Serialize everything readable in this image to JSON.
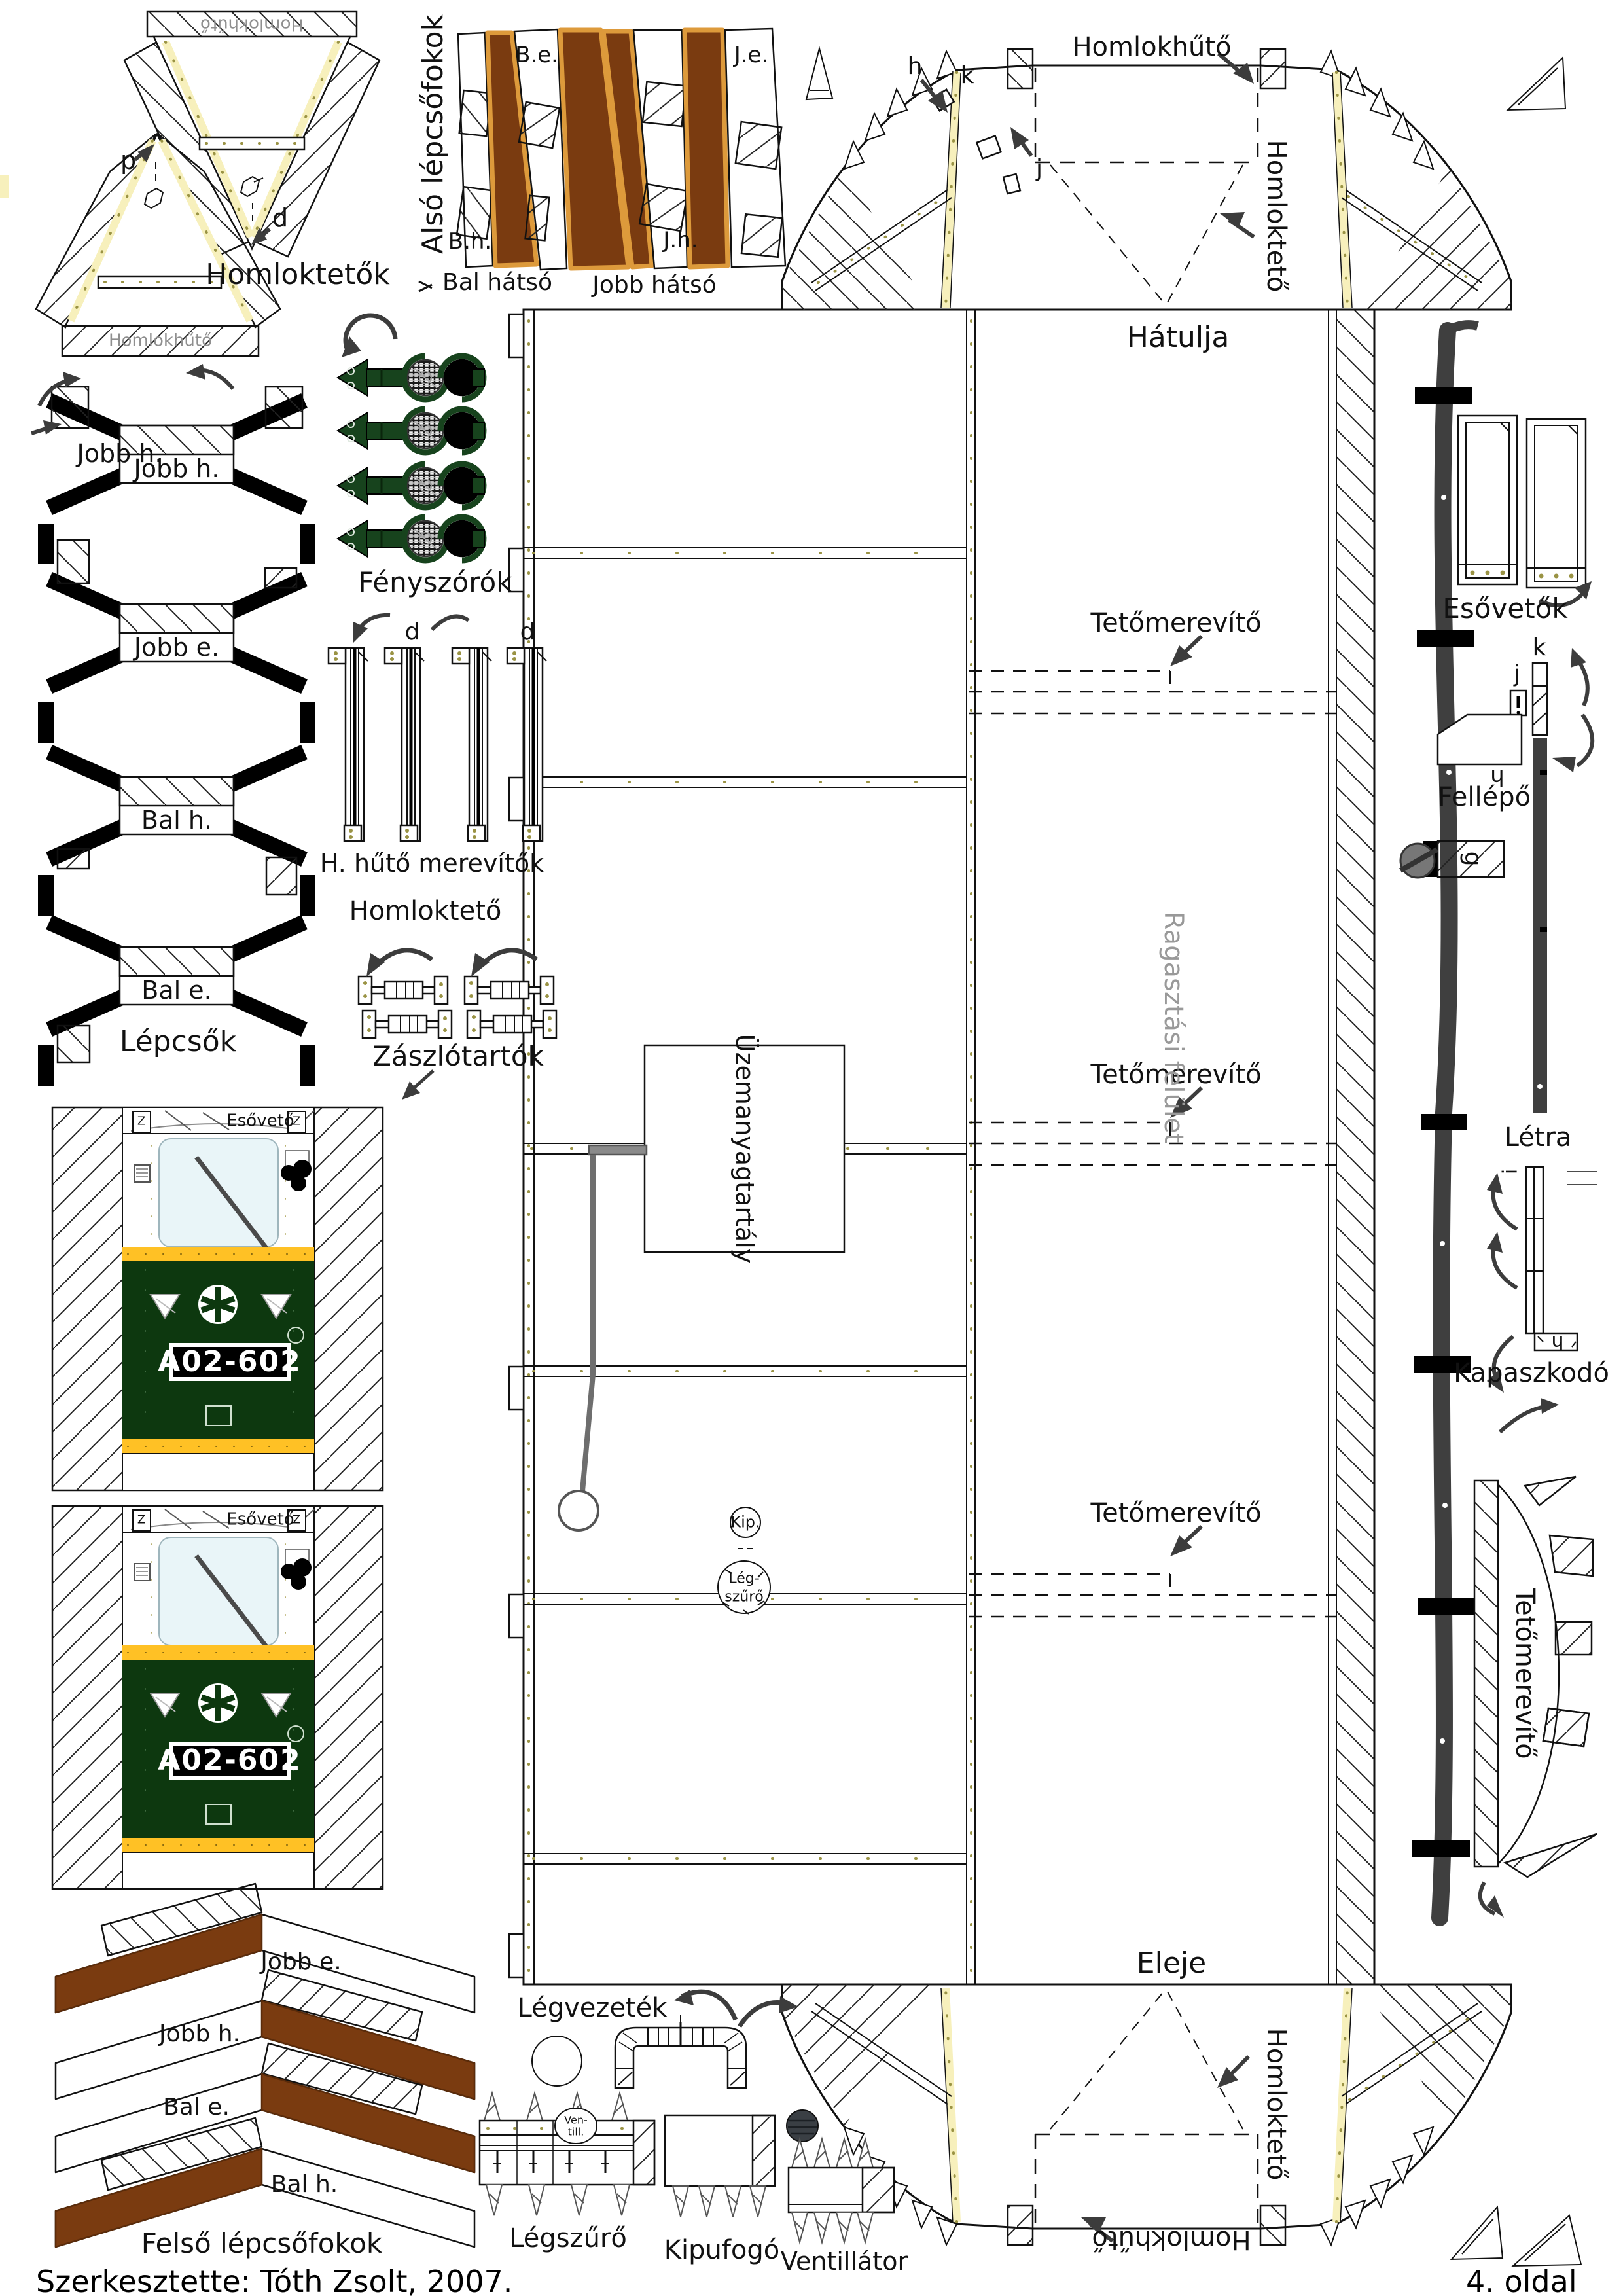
{
  "sheet": {
    "credit": "Szerkesztette: Tóth Zsolt, 2007.",
    "page": "4. oldal"
  },
  "colors": {
    "brown": "#7a3b10",
    "brown_edge": "#dd9a3b",
    "dark_green": "#0d380f",
    "stripe_yellow": "#ffc125",
    "window_blue": "#e9f5f8",
    "lamp_green": "#17431d",
    "strip_gray": "#3f3f3f",
    "glue_gray": "#999999",
    "cream": "#f7f0bc"
  },
  "top_left": {
    "caption": "Homloktetők",
    "flap_label": "Homlokhűtő",
    "letter_p": "p",
    "letter_d": "d"
  },
  "lower_steps": {
    "caption": "Alsó lépcsőfokok",
    "front_left": "B.e.",
    "front_right": "J.e.",
    "rear_left": "B.h.",
    "rear_right": "J.h.",
    "group_left": "Bal hátsó",
    "group_right": "Jobb hátsó"
  },
  "rear_assembly": {
    "caption": "Hátulja",
    "radiator": "Homlokhűtő",
    "roof": "Homloktető",
    "letter_h": "h",
    "letter_k": "k",
    "letter_j": "j"
  },
  "front_assembly": {
    "caption": "Eleje",
    "radiator": "Homlokhűtő",
    "roof": "Homloktető"
  },
  "headlights": {
    "caption": "Fényszórók"
  },
  "side_steps": {
    "caption": "Lépcsők",
    "steps": [
      "Jobb h.",
      "Jobb e.",
      "Bal h.",
      "Bal e."
    ]
  },
  "radiator_braces": {
    "caption": "H. hűtő merevítők",
    "letter_d": "d"
  },
  "front_roof_note": "Homloktető",
  "flag_holders": {
    "caption": "Zászlótartók"
  },
  "cab": {
    "rain_strip": "Esővető",
    "plate": "A02-602",
    "corner": "Z"
  },
  "main_body": {
    "glue": "Ragasztási felület",
    "fuel": "Üzemanyagtartály",
    "exhaust": "Kip.",
    "filter_top": "Lég-",
    "filter_bottom": "szűrő",
    "brace": "Tetőmerevítő"
  },
  "right_side": {
    "rain_deflectors": "Esővetők",
    "step": "Fellépő",
    "ladder": "Létra",
    "grab": "Kapaszkodó",
    "brace": "Tetőmerevítő",
    "letter_k": "k",
    "letter_j": "j",
    "letter_i": "i",
    "letter_g": "g",
    "letter_h": "h"
  },
  "upper_steps": {
    "caption": "Felső lépcsőfokok",
    "steps": [
      "Jobb e.",
      "Jobb h.",
      "Bal e.",
      "Bal h."
    ]
  },
  "pipes": {
    "duct": "Légvezeték",
    "filter": "Légszűrő",
    "exhaust": "Kipufogó",
    "fan": "Ventillátor",
    "fan_short_1": "Ven-",
    "fan_short_2": "till."
  }
}
